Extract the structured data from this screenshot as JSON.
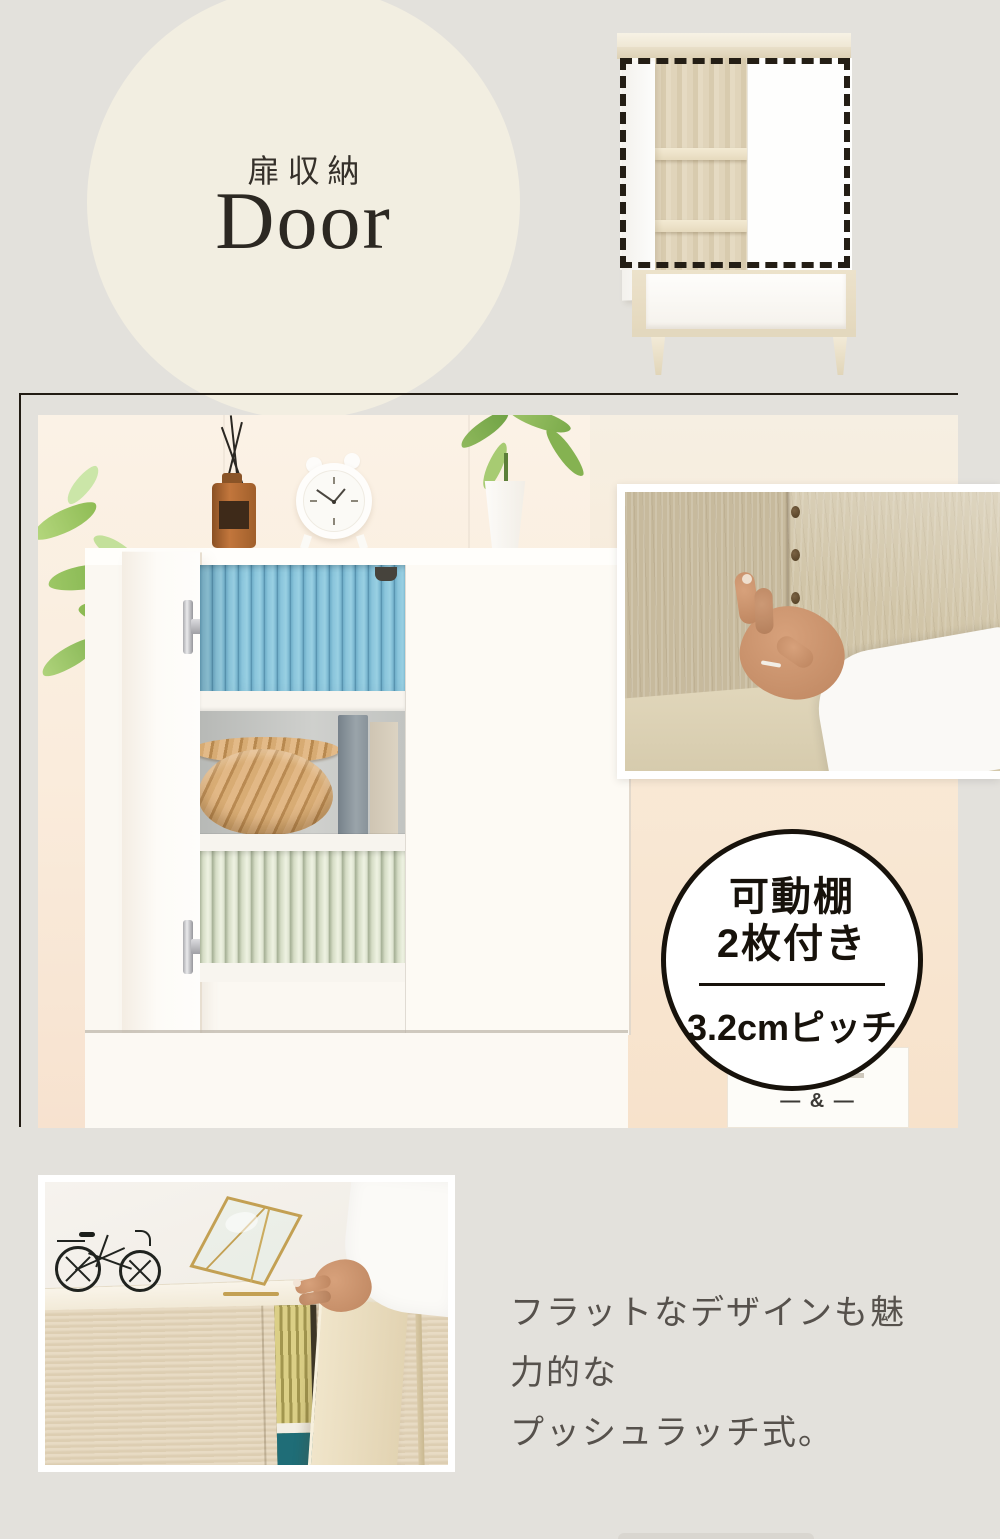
{
  "colors": {
    "page_bg": "#E3E1DC",
    "hero_circle": "#F2EEE1",
    "ink": "#2C2822",
    "frame_line": "#221C14",
    "badge_border": "#17120B",
    "blue_books": "#85C3DB",
    "green_books": "#DFE5D1",
    "basket": "#C99B66",
    "wood_light": "#CDC0A3",
    "teal_accent": "#1F6D77",
    "body_text": "#56514C"
  },
  "hero": {
    "subtitle": "扉収納",
    "title": "Door"
  },
  "badge": {
    "line1": "可動棚",
    "line2": "2枚付き",
    "pitch": "3.2cmピッチ"
  },
  "poster": {
    "mark": "— & —"
  },
  "push": {
    "line1": "フラットなデザインも魅力的な",
    "line2": "プッシュラッチ式。"
  }
}
